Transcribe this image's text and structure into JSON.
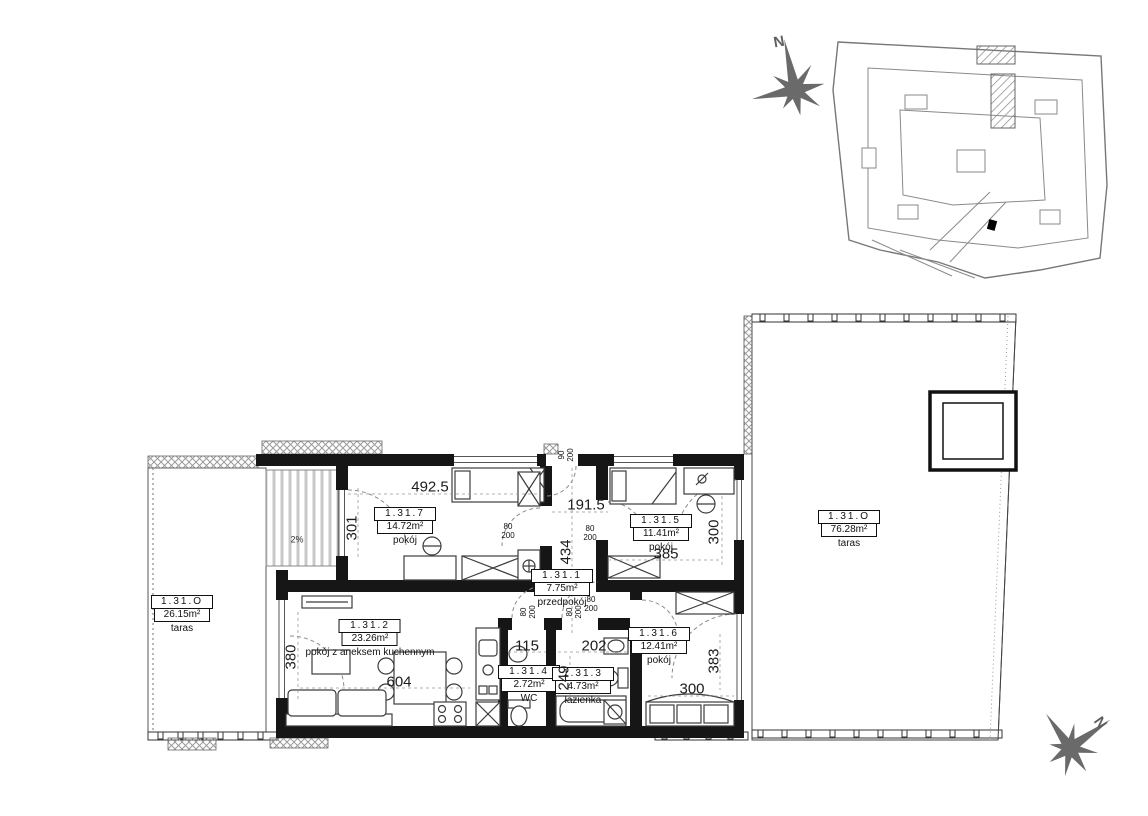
{
  "compass": {
    "north": "N"
  },
  "rooms": {
    "room7": {
      "id": "1.31.7",
      "area": "14.72m²",
      "name": "pokój"
    },
    "hall": {
      "id": "1.31.1",
      "area": "7.75m²",
      "name": "przedpokój"
    },
    "room5": {
      "id": "1.31.5",
      "area": "11.41m²",
      "name": "pokój"
    },
    "living": {
      "id": "1.31.2",
      "area": "23.26m²",
      "name": "pokój z aneksem kuchennym"
    },
    "wc": {
      "id": "1.31.4",
      "area": "2.72m²",
      "name": "WC"
    },
    "bath": {
      "id": "1.31.3",
      "area": "4.73m²",
      "name": "łazienka"
    },
    "room6": {
      "id": "1.31.6",
      "area": "12.41m²",
      "name": "pokój"
    },
    "terrace_left": {
      "id": "1.31.O",
      "area": "26.15m²",
      "name": "taras"
    },
    "terrace_right": {
      "id": "1.31.O",
      "area": "76.28m²",
      "name": "taras"
    }
  },
  "dimensions": {
    "room7_width": "492.5",
    "hall_width": "191.5",
    "hall_length": "434",
    "room7_window_height": "301",
    "room5_depth": "300",
    "room5_width": "385",
    "living_window_height": "380",
    "living_width": "604",
    "wc_width": "115",
    "bath_width": "202",
    "bath_depth": "249",
    "room6_width": "300",
    "room6_depth": "383",
    "loggia_slope": "2%"
  },
  "doors": {
    "standard_width": "80",
    "entrance_width": "90",
    "height": "200"
  },
  "colors": {
    "wall": "#161616",
    "furniture": "#3c3c3c",
    "dim_line": "#999999",
    "compass": "#6a6a6a",
    "site_plan": "#8a8a8a"
  }
}
